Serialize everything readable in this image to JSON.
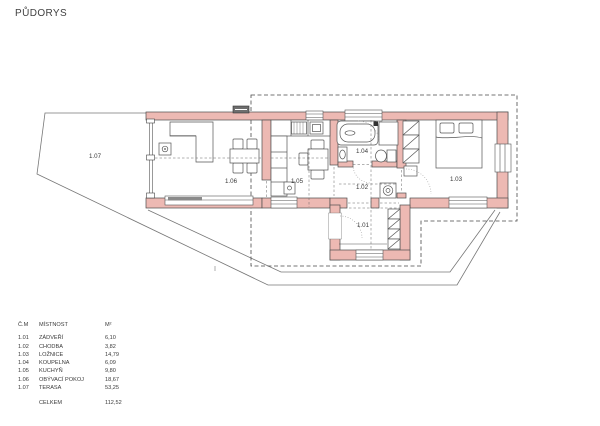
{
  "page": {
    "title": "PŮDORYS"
  },
  "plan": {
    "wall_color": "#edb9b3",
    "rooms": [
      {
        "label": "1.01"
      },
      {
        "label": "1.02"
      },
      {
        "label": "1.03"
      },
      {
        "label": "1.04"
      },
      {
        "label": "1.05"
      },
      {
        "label": "1.06"
      },
      {
        "label": "1.07"
      }
    ]
  },
  "table": {
    "header": {
      "num": "Č.M",
      "name": "MÍSTNOST",
      "area": "M²"
    },
    "rows": [
      {
        "num": "1.01",
        "name": "ZÁDVEŘÍ",
        "area": "6,10"
      },
      {
        "num": "1.02",
        "name": "CHODBA",
        "area": "3,82"
      },
      {
        "num": "1.03",
        "name": "LOŽNICE",
        "area": "14,79"
      },
      {
        "num": "1.04",
        "name": "KOUPELNA",
        "area": "6,09"
      },
      {
        "num": "1.05",
        "name": "KUCHYŇ",
        "area": "9,80"
      },
      {
        "num": "1.06",
        "name": "OBÝVACÍ POKOJ",
        "area": "18,67"
      },
      {
        "num": "1.07",
        "name": "TERASA",
        "area": "53,25"
      }
    ],
    "total": {
      "label": "CELKEM",
      "value": "112,52"
    }
  }
}
